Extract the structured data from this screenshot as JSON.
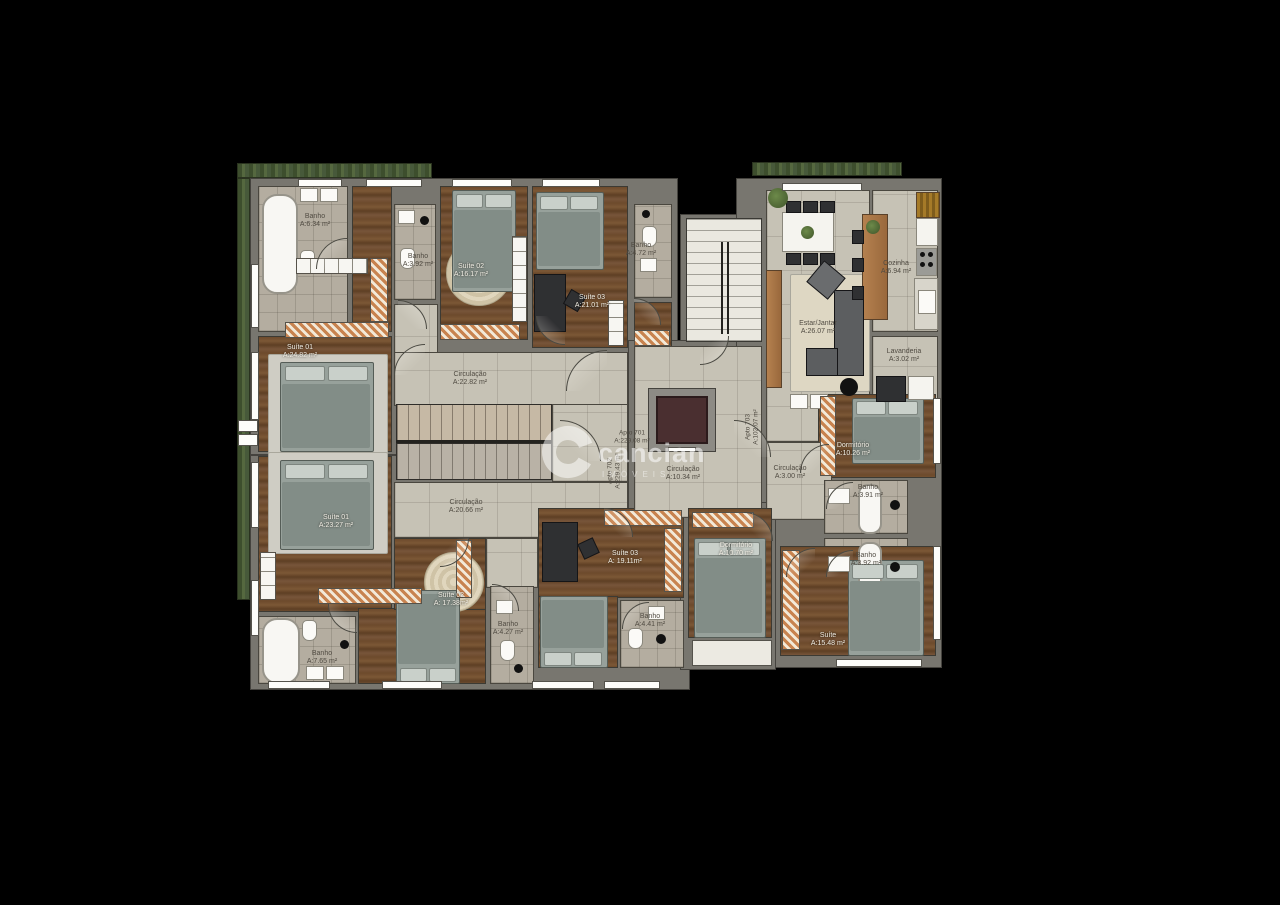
{
  "watermark": {
    "brand": "cancian",
    "sub": "IMÓVEIS"
  },
  "apartments": {
    "apto701": {
      "name": "Apto 701",
      "area": "A:229.08 m²"
    },
    "apto702": {
      "name": "Apto 702",
      "area": "A:229.43 m²"
    },
    "apto703": {
      "name": "Apto 703",
      "area": "A:102.07 m²"
    }
  },
  "rooms": {
    "u701_banho1": {
      "name": "Banho",
      "area": "A:6.34 m²"
    },
    "u701_suite01": {
      "name": "Suíte 01",
      "area": "A:24.82 m²"
    },
    "u701_banho2": {
      "name": "Banho",
      "area": "A:3.92 m²"
    },
    "u701_suite02": {
      "name": "Suíte 02",
      "area": "A:16.17 m²"
    },
    "u701_suite03": {
      "name": "Suíte 03",
      "area": "A:21.01 m²"
    },
    "u701_banho3": {
      "name": "Banho",
      "area": "A:4.72 m²"
    },
    "u701_circ": {
      "name": "Circulação",
      "area": "A:22.82 m²"
    },
    "u702_circ": {
      "name": "Circulação",
      "area": "A:20.66 m²"
    },
    "u702_suite01": {
      "name": "Suíte 01",
      "area": "A:23.27 m²"
    },
    "u702_banho1": {
      "name": "Banho",
      "area": "A:7.65 m²"
    },
    "u702_suite02": {
      "name": "Suíte 02",
      "area": "A: 17.38m²"
    },
    "u702_banho2": {
      "name": "Banho",
      "area": "A:4.27 m²"
    },
    "u702_suite03": {
      "name": "Suíte 03",
      "area": "A: 19.11m²"
    },
    "u702_banho3": {
      "name": "Banho",
      "area": "A:4.41 m²"
    },
    "common_circ": {
      "name": "Circulação",
      "area": "A:10.34 m²"
    },
    "u703_estar": {
      "name": "Estar/Jantar",
      "area": "A:26.07 m²"
    },
    "u703_cozinha": {
      "name": "Cozinha",
      "area": "A:6.94 m²"
    },
    "u703_lavand": {
      "name": "Lavanderia",
      "area": "A:3.02 m²"
    },
    "u703_dorm1": {
      "name": "Dormitório",
      "area": "A:10.26 m²"
    },
    "u703_circ": {
      "name": "Circulação",
      "area": "A:3.00 m²"
    },
    "u703_banho1": {
      "name": "Banho",
      "area": "A:3.91 m²"
    },
    "u703_banho2": {
      "name": "Banho",
      "area": "A:3.92 m²"
    },
    "u703_dorm2": {
      "name": "Dormitório",
      "area": "A:10.70 m²"
    },
    "u703_suite": {
      "name": "Suíte",
      "area": "A:15.48 m²"
    }
  },
  "colors": {
    "background": "#000000",
    "wall": "#78766f",
    "tile": "#c6c2b5",
    "wood": "#6d4a2c",
    "elevator": "#4a2f30",
    "hedge": "#47593a"
  }
}
